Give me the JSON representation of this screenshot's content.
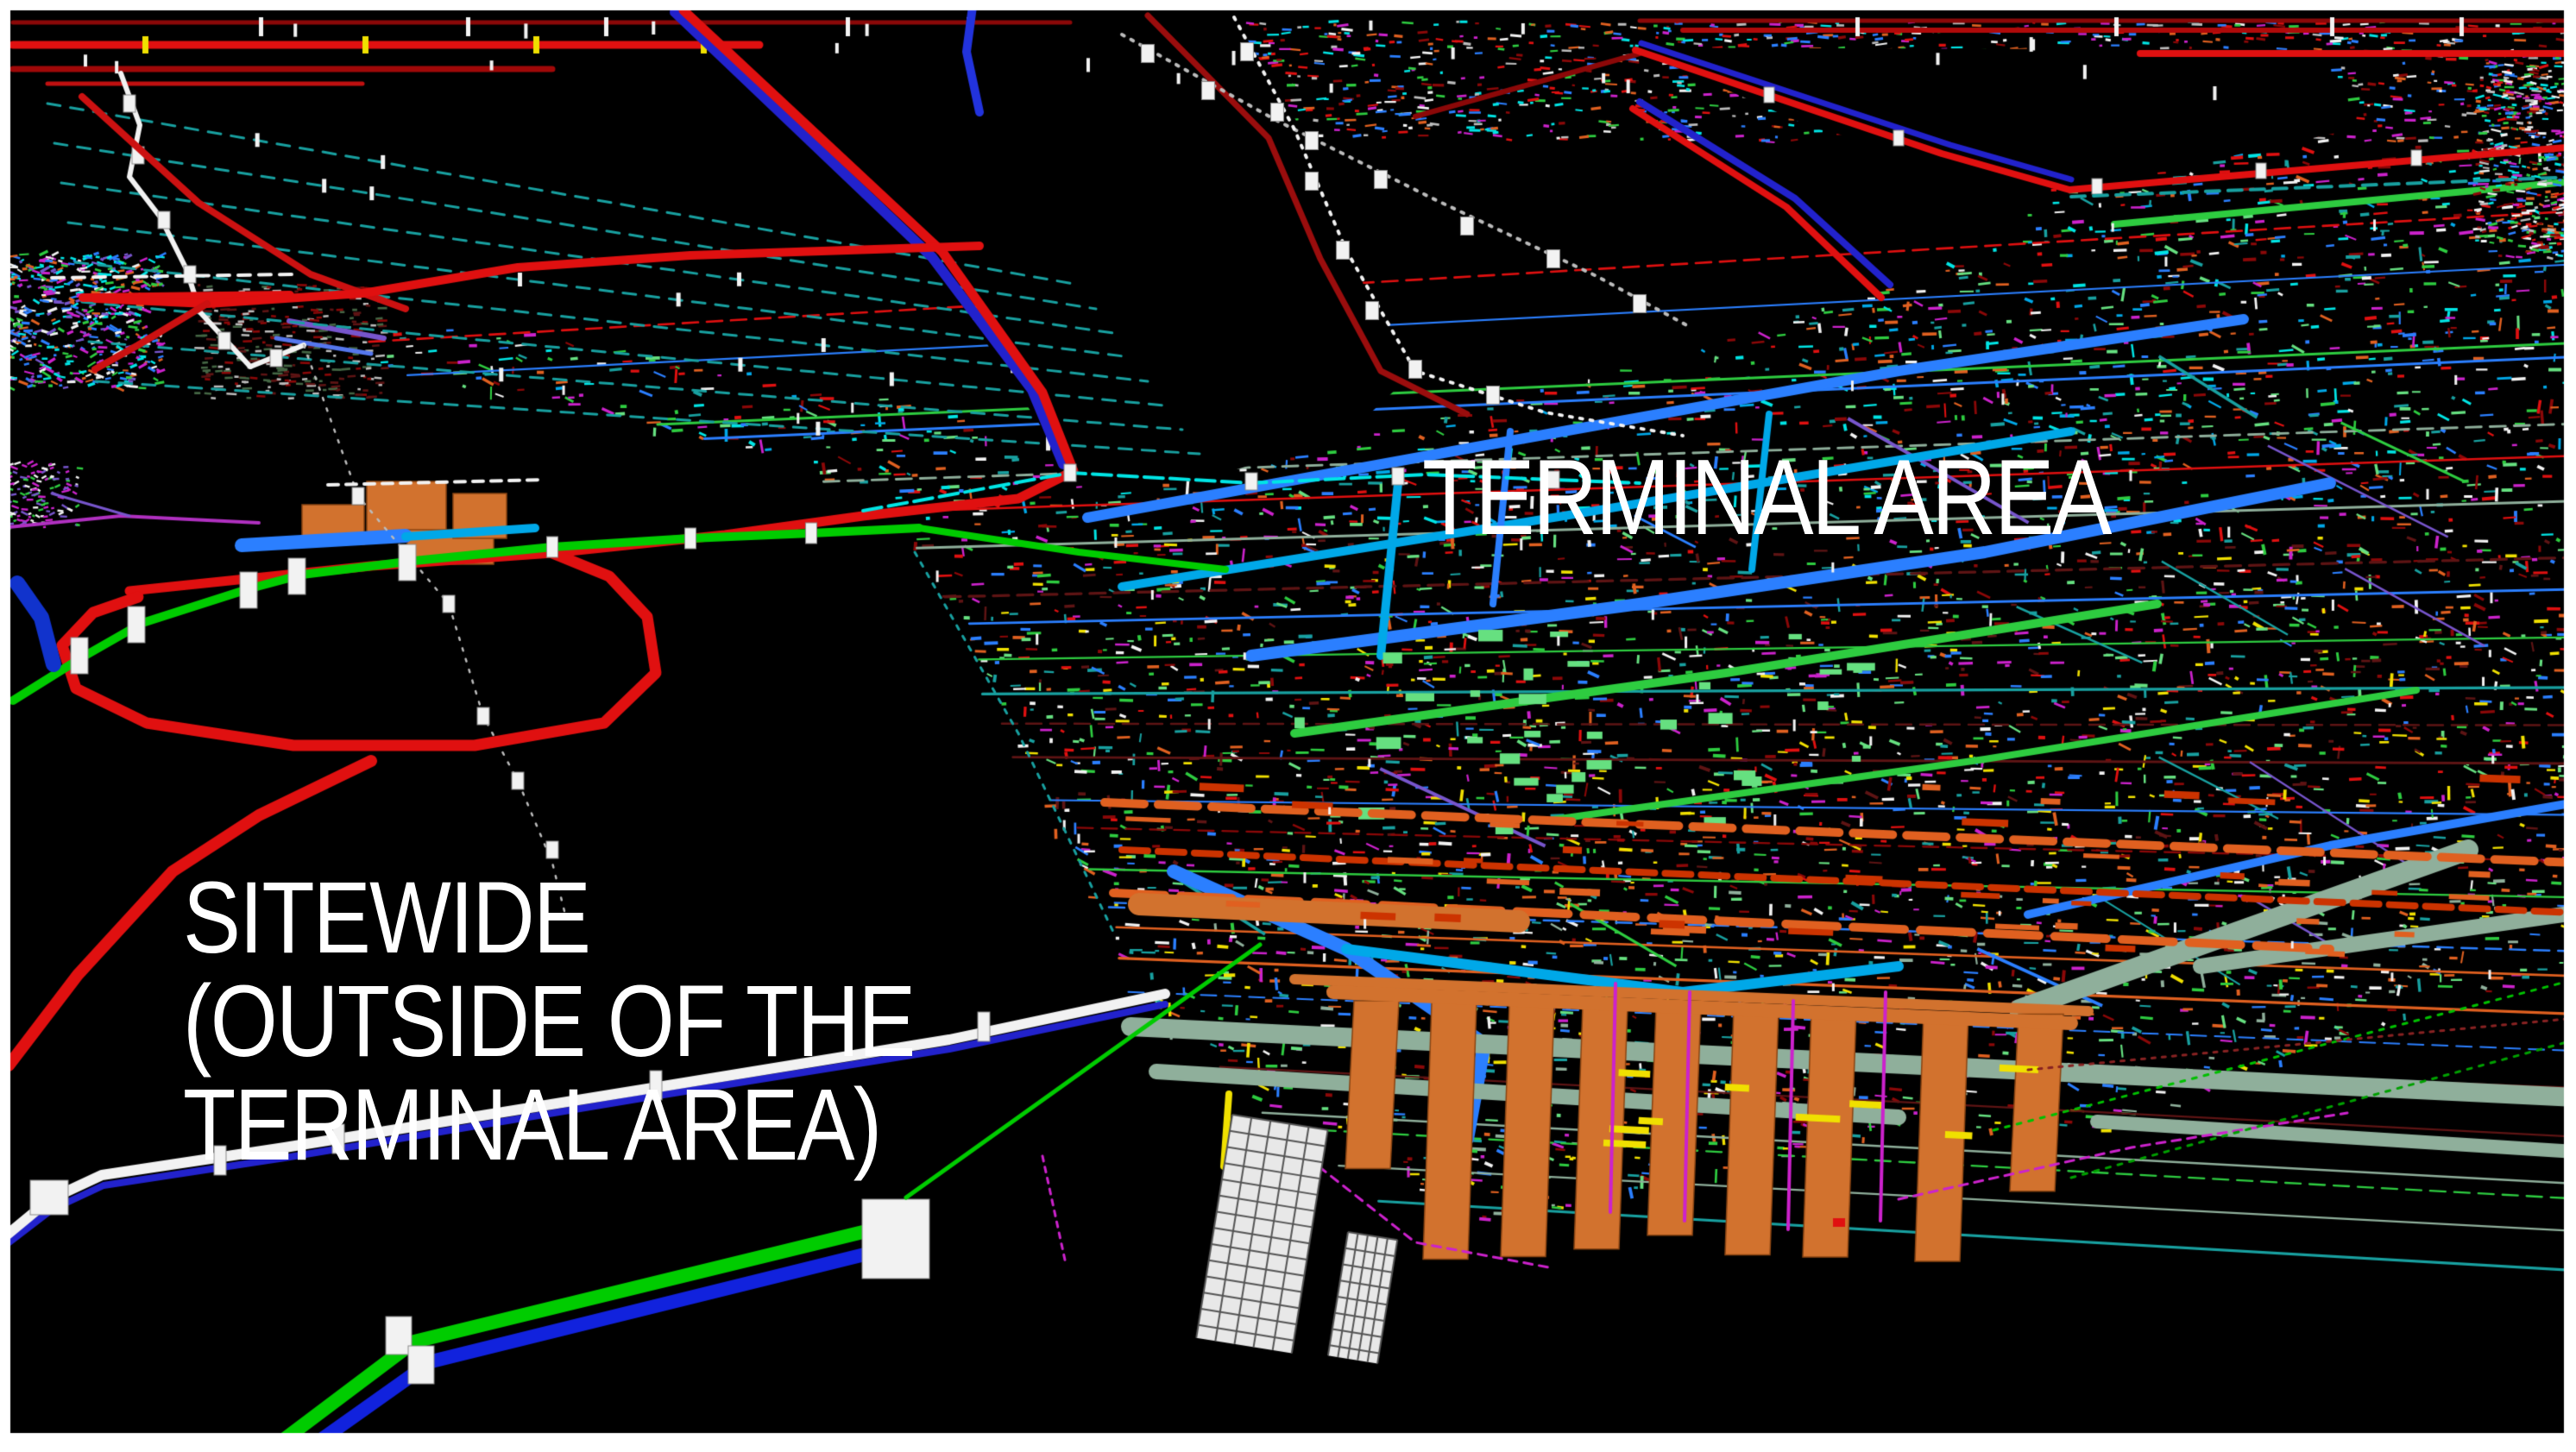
{
  "labels": {
    "terminal_area": "TERMINAL AREA",
    "sitewide_line1": "SITEWIDE",
    "sitewide_line2": "(OUTSIDE OF THE",
    "sitewide_line3": "TERMINAL AREA)"
  },
  "palette": {
    "background": "#000000",
    "frame": "#FFFFFF",
    "label_text": "#FFFFFF",
    "red_bright": "#E01010",
    "red_dark": "#8B0808",
    "maroon": "#5E1414",
    "blue": "#2222CC",
    "blue_pipe": "#2B7FFF",
    "azure": "#00A8E8",
    "cyan": "#00E5E5",
    "teal_dash": "#18A0A0",
    "green_pipe": "#00CC00",
    "green_bright": "#2ECC40",
    "green_soft": "#66E080",
    "sage": "#8FAF9B",
    "orange": "#E06020",
    "orange_duct": "#D2722E",
    "yellow": "#F0E000",
    "magenta": "#CC22CC",
    "purple": "#7755CC",
    "white": "#F2F2F2",
    "gray": "#BBBBBB"
  }
}
